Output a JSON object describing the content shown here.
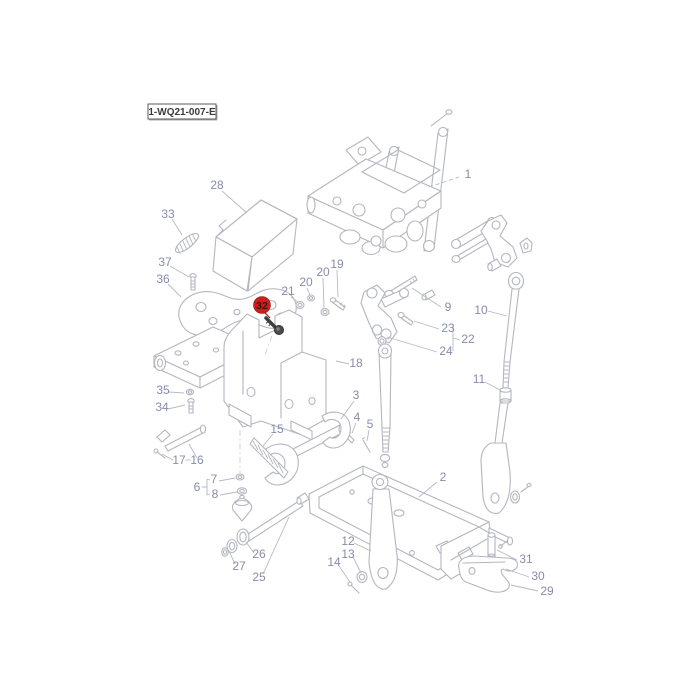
{
  "diagram": {
    "code": "1-WQ21-007-E",
    "type": "exploded-parts-diagram",
    "colors": {
      "line": "#b4b6c0",
      "label": "#878cab",
      "highlight": "#c8211d",
      "highlight_text": "#4a0b08",
      "code_text": "#3a3a3a",
      "dark_part": "#3f3f3f",
      "background": "#ffffff"
    }
  },
  "highlight": {
    "text": "32"
  },
  "labels": [
    {
      "id": "1",
      "text": "1"
    },
    {
      "id": "2",
      "text": "2"
    },
    {
      "id": "3",
      "text": "3"
    },
    {
      "id": "4",
      "text": "4"
    },
    {
      "id": "5",
      "text": "5"
    },
    {
      "id": "6",
      "text": "6"
    },
    {
      "id": "7",
      "text": "7"
    },
    {
      "id": "8",
      "text": "8"
    },
    {
      "id": "9",
      "text": "9"
    },
    {
      "id": "10",
      "text": "10"
    },
    {
      "id": "11",
      "text": "11"
    },
    {
      "id": "12",
      "text": "12"
    },
    {
      "id": "13",
      "text": "13"
    },
    {
      "id": "14",
      "text": "14"
    },
    {
      "id": "15",
      "text": "15"
    },
    {
      "id": "16",
      "text": "16"
    },
    {
      "id": "17",
      "text": "17"
    },
    {
      "id": "18",
      "text": "18"
    },
    {
      "id": "19",
      "text": "19"
    },
    {
      "id": "20a",
      "text": "20"
    },
    {
      "id": "20b",
      "text": "20"
    },
    {
      "id": "21",
      "text": "21"
    },
    {
      "id": "22",
      "text": "22"
    },
    {
      "id": "23",
      "text": "23"
    },
    {
      "id": "24",
      "text": "24"
    },
    {
      "id": "25",
      "text": "25"
    },
    {
      "id": "26",
      "text": "26"
    },
    {
      "id": "27",
      "text": "27"
    },
    {
      "id": "28",
      "text": "28"
    },
    {
      "id": "29",
      "text": "29"
    },
    {
      "id": "30",
      "text": "30"
    },
    {
      "id": "31",
      "text": "31"
    },
    {
      "id": "33",
      "text": "33"
    },
    {
      "id": "34",
      "text": "34"
    },
    {
      "id": "35",
      "text": "35"
    },
    {
      "id": "36",
      "text": "36"
    },
    {
      "id": "37",
      "text": "37"
    }
  ]
}
